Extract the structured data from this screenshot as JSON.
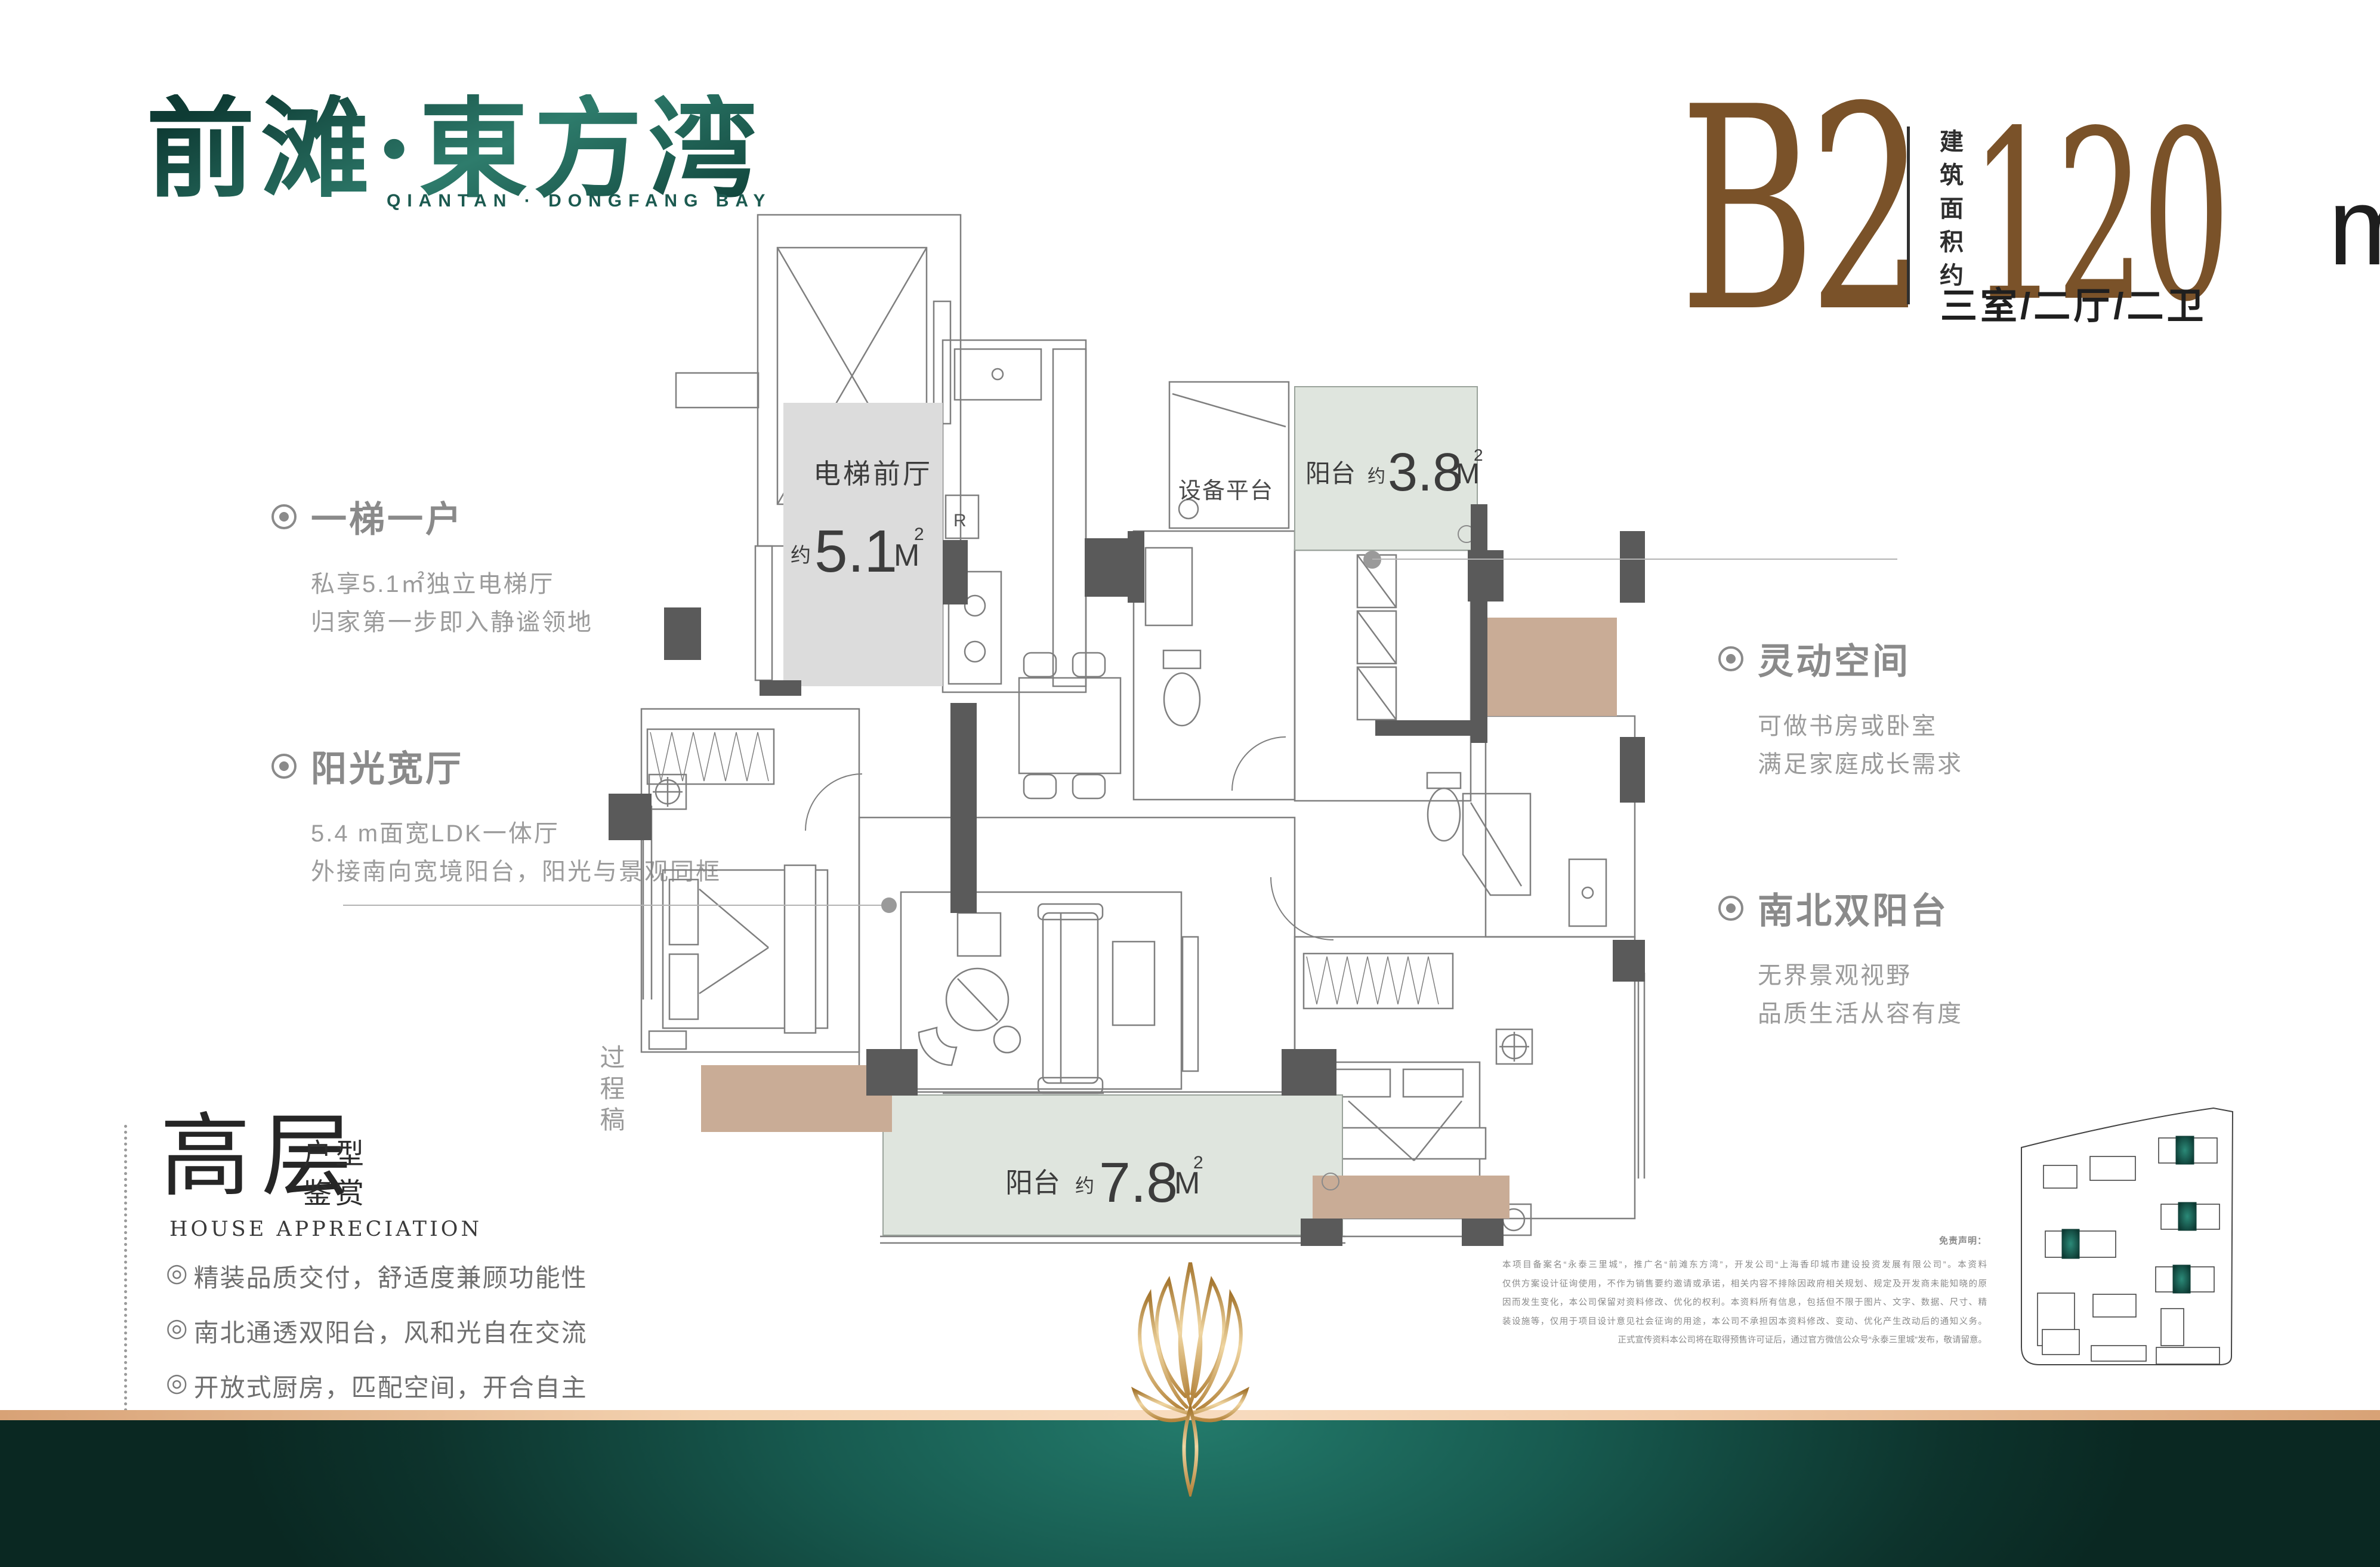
{
  "brand": {
    "logo_cn": "前滩·東方湾",
    "logo_en": "QIANTAN · DONGFANG BAY"
  },
  "unit": {
    "code": "B2",
    "area_label_vertical": "建筑面积约",
    "area_value": "120",
    "area_unit": "m",
    "area_sup": "2",
    "rooms": "三室/二厅/二卫"
  },
  "annotations": {
    "left": [
      {
        "title": "一梯一户",
        "lines": [
          "私享5.1㎡独立电梯厅",
          "归家第一步即入静谧领地"
        ]
      },
      {
        "title": "阳光宽厅",
        "lines": [
          "5.4 m面宽LDK一体厅",
          "外接南向宽境阳台，阳光与景观同框"
        ]
      }
    ],
    "right": [
      {
        "title": "灵动空间",
        "lines": [
          "可做书房或卧室",
          "满足家庭成长需求"
        ]
      },
      {
        "title": "南北双阳台",
        "lines": [
          "无界景观视野",
          "品质生活从容有度"
        ]
      }
    ]
  },
  "appreciation": {
    "title_big": "高层",
    "title_small_1": "户型",
    "title_small_2": "鉴赏",
    "subtitle": "HOUSE APPRECIATION",
    "bullet_icon": "◎",
    "bullets": [
      "精装品质交付，舒适度兼顾功能性",
      "南北通透双阳台，风和光自在交流",
      "开放式厨房，匹配空间，开合自主",
      "动静分离，功能分区零浪费"
    ]
  },
  "floorplan": {
    "labels": {
      "elevator_lobby": "电梯前厅",
      "approx": "约",
      "elevator_lobby_area": "5.1",
      "equipment_platform": "设备平台",
      "balcony": "阳台",
      "balcony_north_area": "3.8",
      "balcony_south_area": "7.8",
      "area_unit": "M",
      "area_sup": "2",
      "fridge": "R",
      "watermark": "过程稿"
    }
  },
  "disclaimer": {
    "heading": "免责声明：",
    "lines": [
      "本项目备案名“永泰三里城”，推广名“前滩东方湾”，开发公司“上海香印城市建设投资发展有限公司”。本资料",
      "仅供方案设计征询使用，不作为销售要约邀请或承诺，相关内容不排除因政府相关规划、规定及开发商未能知晓的原",
      "因而发生变化，本公司保留对资料修改、优化的权利。本资料所有信息，包括但不限于图片、文字、数据、尺寸、精",
      "装设施等，仅用于项目设计意见社会征询的用途，本公司不承担因本资料修改、变动、优化产生改动后的通知义务。",
      "正式宣传资料本公司将在取得预售许可证后，通过官方微信公众号“永泰三里城”发布，敬请留意。"
    ]
  },
  "colors": {
    "brand_teal": "#1d5d52",
    "accent_brown": "#7a5229",
    "wall_gray": "#5a5a5a",
    "lobby_fill": "#dcdcdc",
    "balcony_fill": "#dfe5de",
    "wardrobe_tan": "#c9ac96",
    "band_copper": "#f1ccaa",
    "band_green": "#14584f",
    "gold": "#d1a05c",
    "annotation_gray": "#8a8a8a"
  }
}
